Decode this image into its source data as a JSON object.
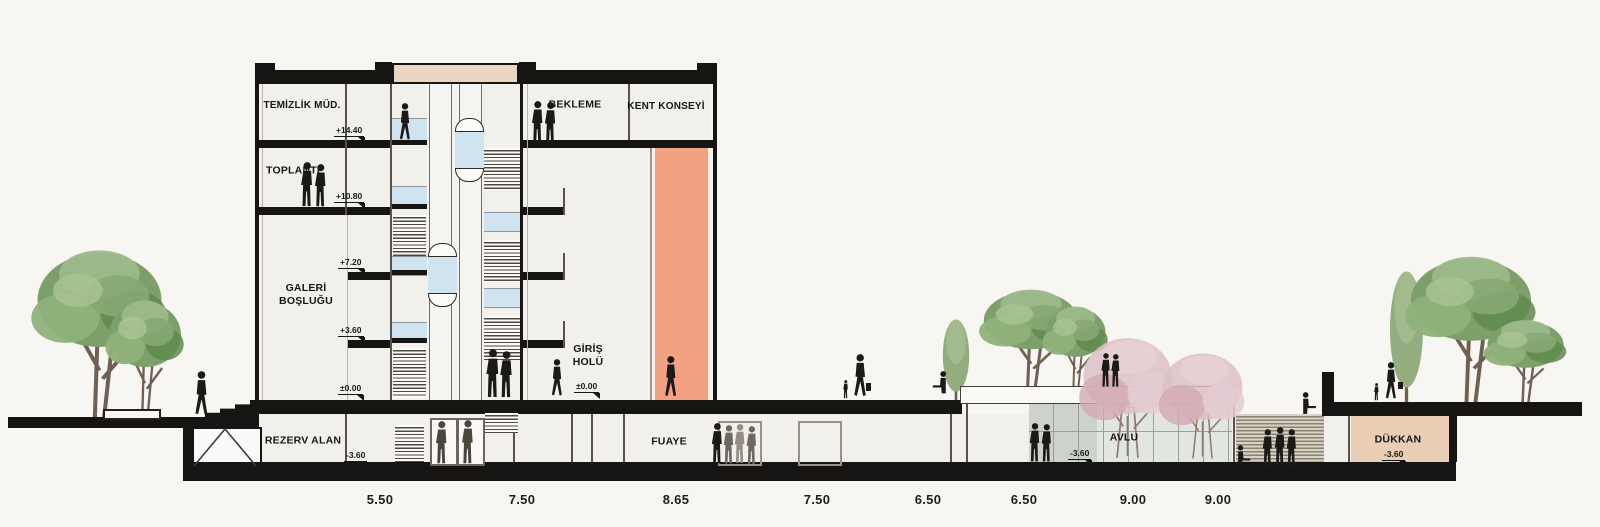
{
  "drawing": {
    "title": "Architectural building cross-section (kesit)",
    "rooms": {
      "temizlik_mud": "TEMİZLİK MÜD.",
      "toplanti": "TOPLANTI",
      "galeri_boslugu": "GALERİ BOŞLUĞU",
      "bekleme": "BEKLEME",
      "kent_konseyi": "KENT KONSEYİ",
      "giris_holu": "GİRİŞ HOLÜ",
      "rezerv_alan": "REZERV ALAN",
      "fuaye": "FUAYE",
      "avlu": "AVLU",
      "dukkan": "DÜKKAN"
    },
    "elevation_markers": [
      "+14.40",
      "+10.80",
      "+7.20",
      "+3.60",
      "±0.00",
      "±0.00",
      "-3.60",
      "-3.60",
      "-3.60"
    ],
    "dimensions": [
      "5.50",
      "7.50",
      "8.65",
      "7.50",
      "6.50",
      "6.50",
      "9.00",
      "9.00"
    ],
    "colors": {
      "background": "#f7f6f2",
      "ink": "#161616",
      "slab": "#171513",
      "salmon": "#f2a183",
      "peach": "#edd5c2",
      "tan": "#e9cdb5",
      "glass_blue": "#cfe4ef",
      "glass_gray": "#e2e6e1",
      "tree_green": "#7da06b",
      "tree_pink": "#dcc0c7",
      "figure_gray": "#6f6860"
    }
  }
}
